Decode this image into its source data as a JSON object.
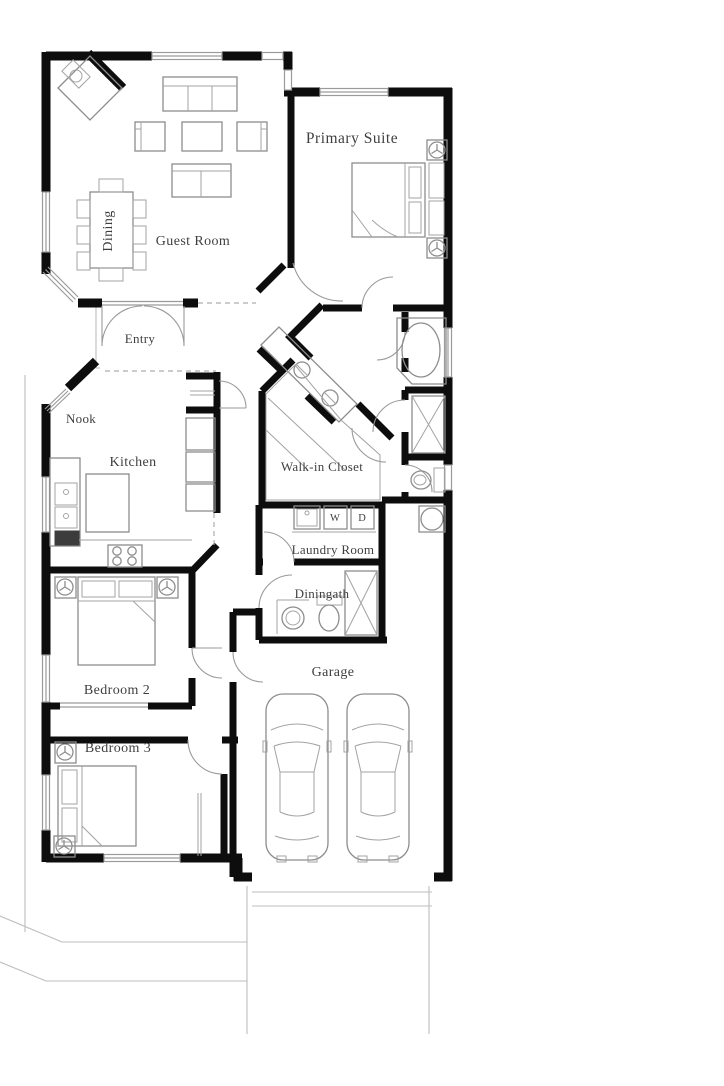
{
  "colors": {
    "walls": "#0d0d0d",
    "furniture_outline": "#8d8d8d",
    "label_text": "#3f3f3f",
    "background": "#ffffff"
  },
  "rooms": {
    "dining": {
      "label": "Dining"
    },
    "guest_room": {
      "label": "Guest Room"
    },
    "primary_suite": {
      "label": "Primary Suite"
    },
    "entry": {
      "label": "Entry"
    },
    "nook": {
      "label": "Nook"
    },
    "kitchen": {
      "label": "Kitchen"
    },
    "walk_in_closet": {
      "label": "Walk-in Closet"
    },
    "laundry_room": {
      "label": "Laundry Room"
    },
    "bath": {
      "label": "Diningath"
    },
    "bedroom_2": {
      "label": "Bedroom 2"
    },
    "bedroom_3": {
      "label": "Bedroom 3"
    },
    "garage": {
      "label": "Garage"
    }
  },
  "appliances": {
    "washer_label": "W",
    "dryer_label": "D"
  }
}
